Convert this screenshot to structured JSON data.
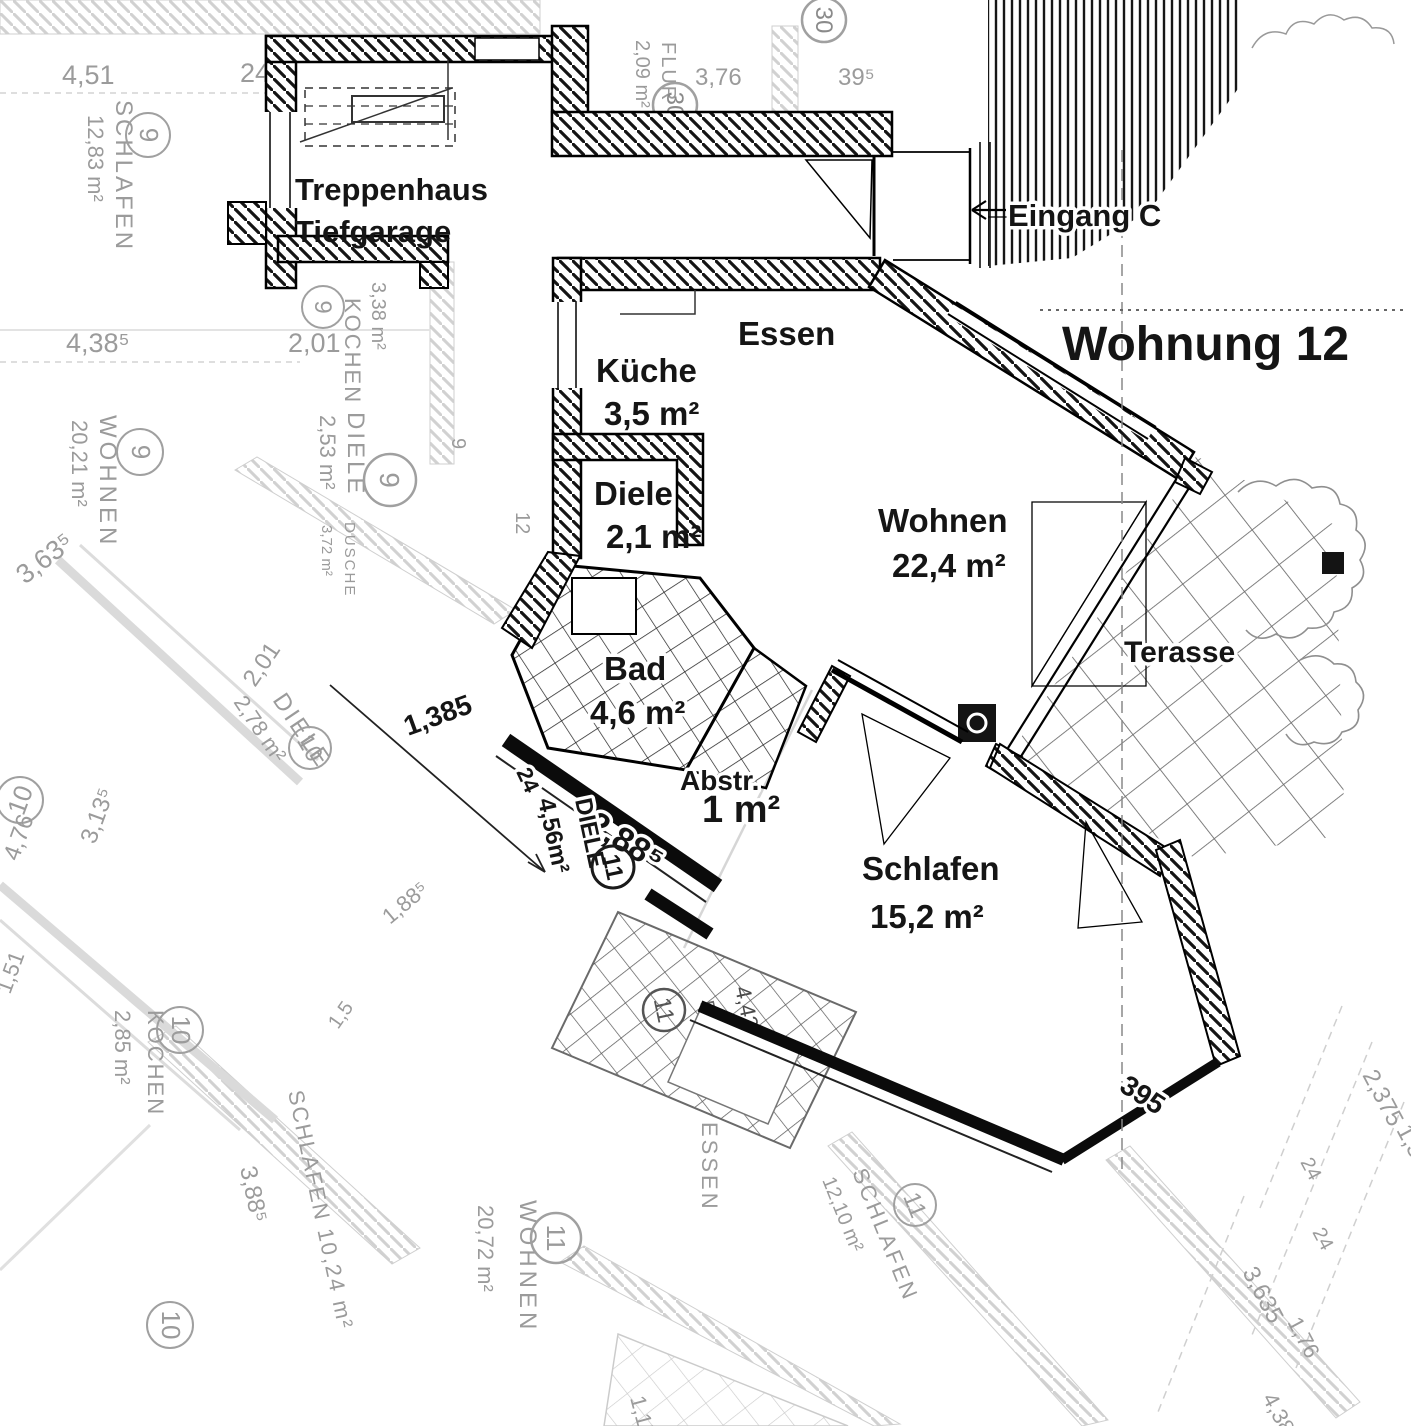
{
  "plan": {
    "title": "Wohnung 12",
    "entrance": "Eingang C",
    "stairwell_line1": "Treppenhaus",
    "stairwell_line2": "Tiefgarage",
    "rooms": {
      "kueche": {
        "name": "Küche",
        "area": "3,5 m²"
      },
      "essen": {
        "name": "Essen"
      },
      "diele": {
        "name": "Diele",
        "area": "2,1 m²"
      },
      "wohnen": {
        "name": "Wohnen",
        "area": "22,4 m²"
      },
      "bad": {
        "name": "Bad",
        "area": "4,6 m²"
      },
      "abstell": {
        "name": "Abstr.",
        "area": "1 m²"
      },
      "schlafen": {
        "name": "Schlafen",
        "area": "15,2 m²"
      },
      "terrasse": {
        "name": "Terasse"
      }
    },
    "dims": {
      "d1385": "1,385",
      "d24": "24",
      "d2885": "2,88⁵",
      "hall_name": "DIELE",
      "hall_area": "4,56m²",
      "unit11": "11",
      "d395": "395"
    }
  },
  "background": {
    "labels": [
      "4,51",
      "24",
      "SCHLAFEN",
      "12,83 m²",
      "9",
      "4,38⁵",
      "2,01",
      "KOCHEN",
      "3,38 m²",
      "9",
      "WOHNEN",
      "20,21 m²",
      "9",
      "DIELE",
      "2,53 m²",
      "9",
      "3,63⁵",
      "DUSCHE",
      "3,72 m²",
      "2,01",
      "DIELE",
      "2,78 m²",
      "10",
      "10",
      "3,13⁵",
      "4,76",
      "1,51",
      "KOCHEN",
      "2,85 m²",
      "10",
      "SCHLAFEN 10,24 m²",
      "3,88⁵",
      "10",
      "WOHNEN",
      "20,72 m²",
      "11",
      "ESSEN",
      "SCHLAFEN",
      "12,10 m²",
      "11",
      "DUSCHE",
      "4,42 m²",
      "11",
      "FLUR",
      "2,09 m²",
      "30",
      "30",
      "3,76",
      "39⁵",
      "2,375",
      "1,38⁵",
      "3,635",
      "1,76",
      "24",
      "24",
      "4,38",
      "1,15",
      "1,88⁵",
      "9",
      "12",
      "1,5"
    ]
  }
}
